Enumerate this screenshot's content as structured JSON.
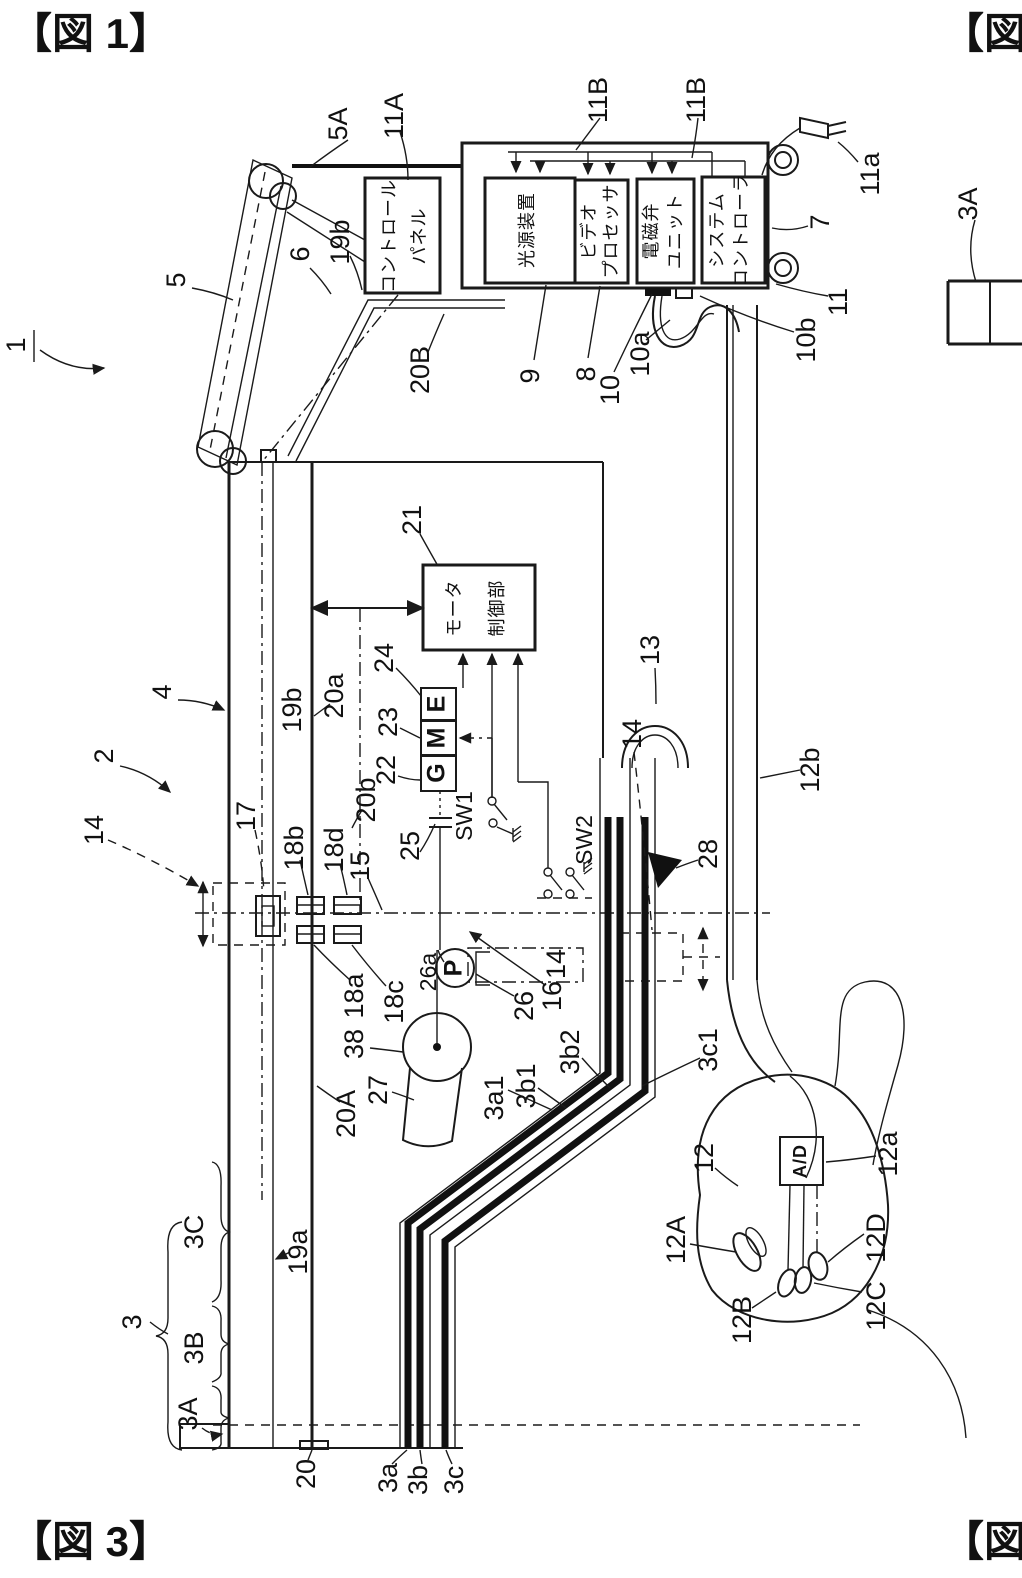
{
  "page": {
    "fig1_marker": "【図 1】",
    "fig3_marker": "【図 3】",
    "fig_partial_marker": "【図"
  },
  "equipment": {
    "control_panel_line1": "コントロール",
    "control_panel_line2": "パネル",
    "light_source": "光源装置",
    "video_line1": "ビデオ",
    "video_line2": "プロセッサ",
    "solenoid_line1": "電磁弁",
    "solenoid_line2": "ユニット",
    "system_line1": "システム",
    "system_line2": "コントローラ",
    "motor_line1": "モータ",
    "motor_line2": "制御部",
    "gear_g": "G",
    "gear_m": "M",
    "gear_e": "E",
    "ad_converter": "A/D",
    "pump": "P",
    "switch1": "SW1",
    "switch2": "SW2"
  },
  "refs": {
    "r1": "1",
    "r2": "2",
    "r3": "3",
    "r4": "4",
    "r5": "5",
    "r5A": "5A",
    "r6": "6",
    "r7": "7",
    "r8": "8",
    "r9": "9",
    "r10": "10",
    "r10a": "10a",
    "r10b": "10b",
    "r11": "11",
    "r11A": "11A",
    "r11B": "11B",
    "r11a": "11a",
    "r12": "12",
    "r12A": "12A",
    "r12B": "12B",
    "r12C": "12C",
    "r12D": "12D",
    "r12a": "12a",
    "r12b": "12b",
    "r13": "13",
    "r14": "14",
    "r15": "15",
    "r16": "16",
    "r17": "17",
    "r18a": "18a",
    "r18b": "18b",
    "r18c": "18c",
    "r18d": "18d",
    "r19a": "19a",
    "r19b": "19b",
    "r20": "20",
    "r20A": "20A",
    "r20B": "20B",
    "r20a": "20a",
    "r20b": "20b",
    "r21": "21",
    "r22": "22",
    "r23": "23",
    "r24": "24",
    "r25": "25",
    "r26": "26",
    "r26a": "26a",
    "r27": "27",
    "r28": "28",
    "r38": "38",
    "r3A": "3A",
    "r3B": "3B",
    "r3C": "3C",
    "r3a": "3a",
    "r3b": "3b",
    "r3c": "3c",
    "r3a1": "3a1",
    "r3b1": "3b1",
    "r3b2": "3b2",
    "r3c1": "3c1"
  }
}
